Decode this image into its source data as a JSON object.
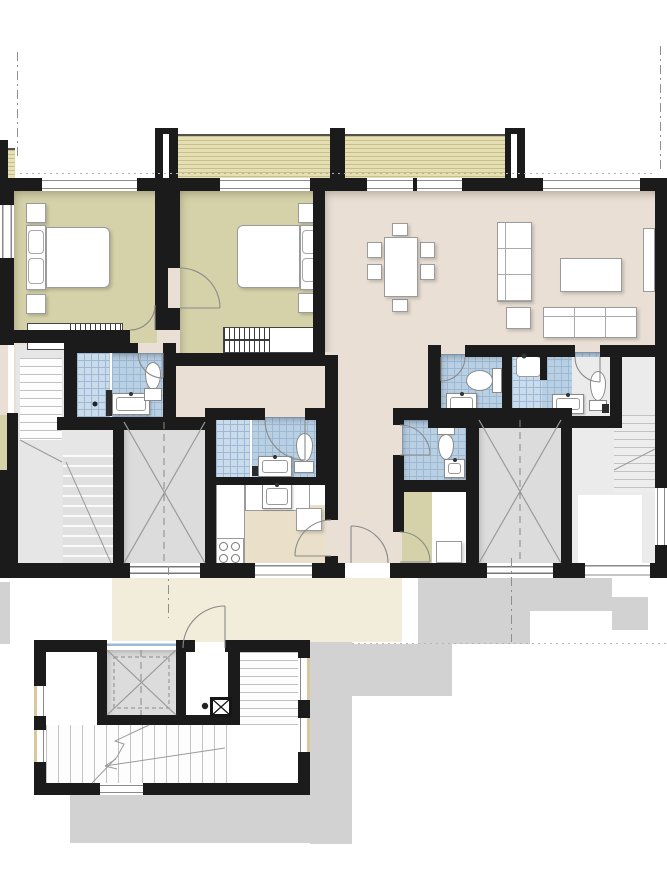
{
  "image": {
    "type": "architectural-floor-plan",
    "view": "top-down rendered plan, no text annotations",
    "building": "residential multi-unit floor with two stair/elevator cores and lower entrance stairwell"
  },
  "colors": {
    "wall": "#1b1b1b",
    "bedroom": "#d5d2a9",
    "living": "#e9dfd4",
    "hall": "#f2ecdb",
    "balcony": "#e5dfb2",
    "tile": "#b9cfe2",
    "tileLine": "#9cb8d5",
    "shower": "#cadbeb",
    "core": "#dcdcdc",
    "stairGray": "#e6e6e6",
    "shadow": "#d2d2d2",
    "furniture": "#ffffff",
    "furnitureLine": "#9b9b9b",
    "sillTan": "#d9c79e"
  },
  "legend": {
    "rooms": [
      "bedroom-1",
      "bedroom-2",
      "living-dining-room",
      "bathroom-1",
      "bathroom-2",
      "kitchen",
      "corridor",
      "wc",
      "laundry-room",
      "bathroom-3",
      "bathroom-4",
      "elevator-1",
      "elevator-2",
      "stairwell-left",
      "stairwell-right",
      "balcony-left",
      "balcony-right",
      "entrance-hall",
      "entrance-stairwell",
      "entrance-elevator"
    ],
    "fixtures": {
      "double_beds": 2,
      "wardrobes": 2,
      "dining_chairs": 6,
      "sofas": 2,
      "coffee_tables": 2,
      "toilets": 5,
      "wash_basins": 6,
      "showers": 3,
      "stove_burners": 4,
      "washing_machines": 1,
      "elevators": 3,
      "stair_flights": 5
    }
  }
}
